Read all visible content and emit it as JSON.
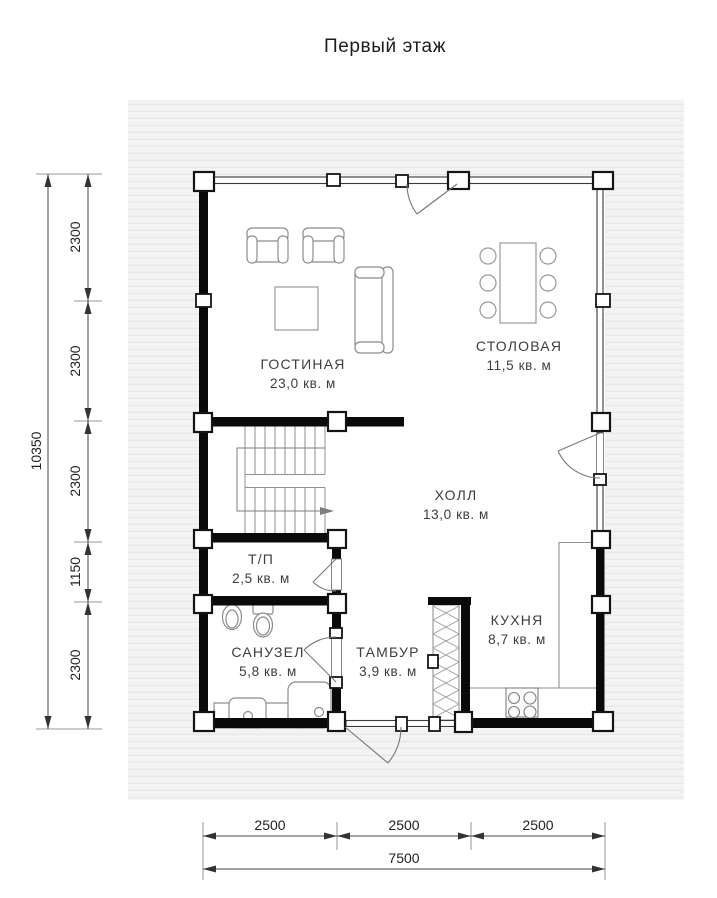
{
  "title": "Первый этаж",
  "rooms": [
    {
      "name": "ГОСТИНАЯ",
      "area": "23,0 кв. м"
    },
    {
      "name": "СТОЛОВАЯ",
      "area": "11,5 кв. м"
    },
    {
      "name": "ХОЛЛ",
      "area": "13,0 кв. м"
    },
    {
      "name": "Т/П",
      "area": "2,5 кв. м"
    },
    {
      "name": "САНУЗЕЛ",
      "area": "5,8 кв. м"
    },
    {
      "name": "ТАМБУР",
      "area": "3,9 кв. м"
    },
    {
      "name": "КУХНЯ",
      "area": "8,7 кв. м"
    }
  ],
  "dims": {
    "left_total": "10350",
    "left_segments": [
      "2300",
      "2300",
      "2300",
      "1150",
      "2300"
    ],
    "bottom_segments": [
      "2500",
      "2500",
      "2500"
    ],
    "bottom_total": "7500"
  },
  "colors": {
    "wall": "#0a0a0a",
    "outline": "#8f8f8f",
    "panel": "#f3f3f3",
    "stripe": "#e7e7e7"
  }
}
